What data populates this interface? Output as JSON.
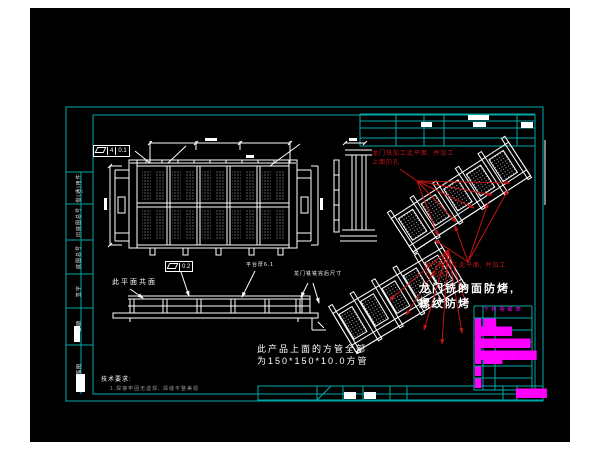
{
  "colors": {
    "background": "#000000",
    "page_margin": "#ffffff",
    "frame_cyan": "#00a9a9",
    "drawing_white": "#ffffff",
    "annotation_red": "#c61414",
    "table_magenta": "#ff00ff"
  },
  "notes": {
    "red_top_1": "龙门铣加工此平面, 并加工",
    "red_top_2": "上面的孔",
    "red_mid_1": "龙门铣加工此平面, 并加工",
    "red_mid_2": "上面的孔",
    "big_1": "龙门铣的面防烤,",
    "big_2": "螺纹防烤",
    "coplanar": "此平面共面",
    "platform": "平台厚6.1",
    "mill_after": "龙门铣铣完后尺寸",
    "tube_1": "此产品上面的方管全部",
    "tube_2": "为150*150*10.0方管",
    "tech_title": "技术要求:",
    "tech_item": "1.焊接牢固无虚焊, 焊缝平整美观"
  },
  "fcf": {
    "top_datum": "4",
    "top_value": "0.1",
    "side_value": "0.2"
  },
  "left_strip": {
    "cells": [
      {
        "label": "借(通)用件登记"
      },
      {
        "label": "旧底图总号"
      },
      {
        "label": "底图总号"
      },
      {
        "label": "签字"
      },
      {
        "label": "日期"
      },
      {
        "label": "描图"
      }
    ]
  },
  "parts_table": {
    "title": "下料明细表",
    "rows": [
      "█ ██ ██████",
      "█ █████████",
      "█ ██████████",
      "█ ███",
      "█",
      "█"
    ],
    "bottom_mark": "█████"
  }
}
